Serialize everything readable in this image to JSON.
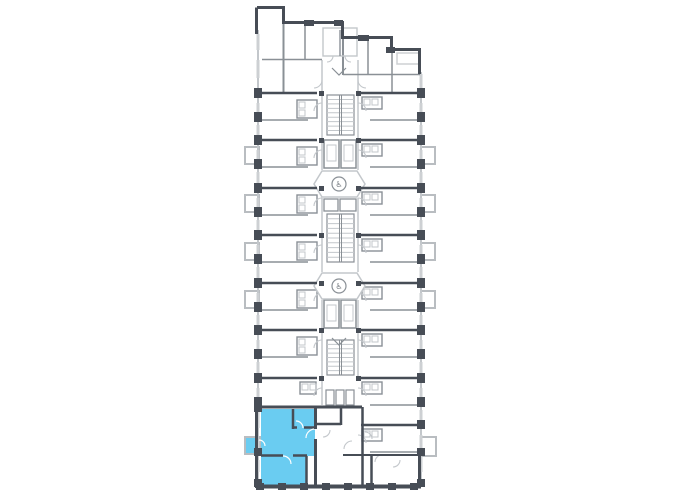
{
  "canvas": {
    "width": 680,
    "height": 500,
    "background": "#ffffff"
  },
  "palette": {
    "wall_dark": "#474d56",
    "wall_medium": "#8a9096",
    "wall_light": "#c3c7cb",
    "window": "#cdd0d3",
    "balcony_stroke": "#b9bdc1",
    "highlight_fill": "#6accf1",
    "glyph": "#70767c"
  },
  "icons": {
    "elevator_symbol": "♿"
  },
  "plan": {
    "outline_dark": [
      [
        257,
        7.5,
        285,
        7.5,
        3
      ],
      [
        283.5,
        7.5,
        283.5,
        24,
        3
      ],
      [
        283,
        22.5,
        344,
        22.5,
        3
      ],
      [
        342.5,
        22.5,
        342.5,
        39,
        3
      ],
      [
        343,
        37.5,
        393,
        37.5,
        3
      ],
      [
        391.5,
        37.5,
        391.5,
        51,
        3
      ],
      [
        392,
        49.5,
        421,
        49.5,
        3
      ],
      [
        419.5,
        49.5,
        419.5,
        74,
        3
      ],
      [
        256.5,
        7.5,
        256.5,
        34,
        3
      ],
      [
        258,
        486.5,
        421,
        486.5,
        4
      ],
      [
        419.5,
        455,
        419.5,
        488,
        3
      ],
      [
        256.5,
        400,
        256.5,
        488,
        3
      ]
    ],
    "dark_walls": [
      [
        259,
        93,
        317,
        93,
        2.5
      ],
      [
        259,
        140,
        317,
        140,
        2.5
      ],
      [
        259,
        188,
        317,
        188,
        2.5
      ],
      [
        259,
        235,
        317,
        235,
        2.5
      ],
      [
        259,
        283,
        317,
        283,
        2.5
      ],
      [
        259,
        330,
        317,
        330,
        2.5
      ],
      [
        259,
        378,
        317,
        378,
        2.5
      ],
      [
        256,
        407,
        317,
        407,
        3
      ],
      [
        361,
        93,
        420,
        93,
        2.5
      ],
      [
        361,
        140,
        420,
        140,
        2.5
      ],
      [
        361,
        188,
        420,
        188,
        2.5
      ],
      [
        361,
        235,
        420,
        235,
        2.5
      ],
      [
        361,
        283,
        420,
        283,
        2.5
      ],
      [
        361,
        330,
        420,
        330,
        2.5
      ],
      [
        361,
        378,
        420,
        378,
        2.5
      ],
      [
        361,
        425,
        420,
        425,
        2.5
      ],
      [
        315.5,
        407,
        315.5,
        429,
        3
      ],
      [
        315.5,
        439,
        315.5,
        488,
        3
      ],
      [
        341,
        407,
        341,
        425,
        2.5
      ],
      [
        362.5,
        407,
        362.5,
        488,
        2.5
      ],
      [
        316,
        424,
        341,
        424,
        2.5
      ],
      [
        343,
        455,
        420,
        455,
        2
      ],
      [
        371.5,
        455,
        371.5,
        488,
        2.5
      ],
      [
        316,
        407,
        362,
        407,
        3
      ]
    ],
    "medium_walls": [
      [
        283.5,
        24,
        283.5,
        93,
        2
      ],
      [
        305,
        24,
        305,
        60,
        1.5
      ],
      [
        262,
        59.5,
        322,
        59.5,
        1.5
      ],
      [
        343,
        39,
        343,
        75,
        2
      ],
      [
        368,
        39,
        368,
        75,
        1.5
      ],
      [
        392,
        51,
        392,
        93,
        1.5
      ],
      [
        343,
        74.5,
        420,
        74.5,
        1.5
      ]
    ],
    "light_walls": [
      [
        322,
        60,
        322,
        170,
        1.5
      ],
      [
        322,
        198,
        322,
        272,
        1.5
      ],
      [
        322,
        300,
        322,
        405,
        1.5
      ],
      [
        358,
        60,
        358,
        170,
        1.5
      ],
      [
        358,
        198,
        358,
        272,
        1.5
      ],
      [
        358,
        300,
        358,
        376,
        1.5
      ],
      [
        258,
        30,
        258,
        486,
        2
      ],
      [
        421,
        72,
        421,
        486,
        2
      ]
    ],
    "modules": {
      "left": {
        "ys": [
          93,
          140,
          188,
          235,
          283,
          330
        ],
        "partition": [
          262,
          308
        ],
        "bath": [
          297,
          7,
          20,
          18
        ],
        "wall_x": 258
      },
      "right": {
        "ys": [
          93,
          140,
          188,
          235,
          283,
          330,
          378,
          425
        ],
        "partition": [
          370,
          420
        ],
        "bath": [
          362,
          4,
          20,
          12
        ],
        "wall_x": 421
      },
      "left_mini": {
        "ys": [
          378
        ],
        "bath": [
          300,
          4,
          16,
          12
        ],
        "wall_x": 258
      }
    },
    "pilasters": {
      "left_x": 254,
      "right_x": 417,
      "w": 8,
      "h": 10,
      "ys": [
        88,
        112,
        135,
        159,
        183,
        207,
        230,
        254,
        278,
        302,
        325,
        349,
        373,
        397
      ],
      "extra": [
        [
          254,
          403,
          8,
          9
        ],
        [
          254,
          448,
          8,
          8
        ],
        [
          254,
          479,
          8,
          8
        ],
        [
          417,
          420,
          8,
          9
        ],
        [
          417,
          448,
          8,
          8
        ],
        [
          417,
          479,
          8,
          8
        ]
      ],
      "bottom_xs": [
        256,
        278,
        300,
        322,
        344,
        366,
        388,
        410
      ],
      "bottom_y": 483,
      "bw": 8,
      "bh": 7,
      "top": [
        [
          304,
          20,
          10,
          6
        ],
        [
          334,
          20,
          9,
          6
        ],
        [
          358,
          35,
          11,
          6
        ],
        [
          386,
          47,
          9,
          6
        ]
      ]
    },
    "windows": {
      "left_extra": [
        [
          34,
          50
        ],
        [
          60,
          78
        ],
        [
          412,
          428
        ],
        [
          440,
          452
        ],
        [
          460,
          472
        ]
      ],
      "right_extra": [
        [
          74,
          88
        ],
        [
          458,
          472
        ]
      ],
      "top": [
        [
          263,
          281,
          7.5
        ],
        [
          289,
          303,
          22.5
        ],
        [
          312,
          326,
          22.5
        ],
        [
          329,
          340,
          22.5
        ],
        [
          347,
          358,
          37.5
        ],
        [
          370,
          388,
          37.5
        ],
        [
          395,
          417,
          49.5
        ]
      ],
      "bottom": {
        "y": 486.5,
        "pairs": [
          [
            265,
            277
          ],
          [
            287,
            299
          ],
          [
            309,
            321
          ],
          [
            331,
            343
          ],
          [
            353,
            365
          ],
          [
            375,
            387
          ],
          [
            397,
            409
          ]
        ]
      },
      "loggia_rect": [
        397,
        53,
        22,
        11
      ]
    },
    "balconies": [
      {
        "x": 245,
        "y": 147,
        "w": 14,
        "h": 17,
        "side": "left"
      },
      {
        "x": 245,
        "y": 195,
        "w": 14,
        "h": 17,
        "side": "left"
      },
      {
        "x": 245,
        "y": 243,
        "w": 14,
        "h": 17,
        "side": "left"
      },
      {
        "x": 245,
        "y": 291,
        "w": 14,
        "h": 17,
        "side": "left"
      },
      {
        "x": 421,
        "y": 147,
        "w": 14,
        "h": 17,
        "side": "right"
      },
      {
        "x": 421,
        "y": 195,
        "w": 14,
        "h": 17,
        "side": "right"
      },
      {
        "x": 421,
        "y": 243,
        "w": 14,
        "h": 17,
        "side": "right"
      },
      {
        "x": 421,
        "y": 291,
        "w": 14,
        "h": 17,
        "side": "right"
      },
      {
        "x": 421,
        "y": 437,
        "w": 15,
        "h": 19,
        "side": "right"
      }
    ],
    "core": {
      "top_room": {
        "rect": [
          323,
          28,
          34,
          28
        ],
        "divider": [
          340,
          30,
          340,
          56
        ]
      },
      "stairs": [
        {
          "x": 327,
          "y": 95,
          "w": 27,
          "h": 40,
          "steps": 9
        },
        {
          "x": 327,
          "y": 214,
          "w": 27,
          "h": 48,
          "steps": 10
        },
        {
          "x": 327,
          "y": 340,
          "w": 27,
          "h": 35,
          "steps": 8
        }
      ],
      "shafts": [
        [
          324,
          140,
          15,
          28
        ],
        [
          341,
          140,
          15,
          28
        ],
        [
          324,
          300,
          15,
          28
        ],
        [
          341,
          300,
          15,
          28
        ]
      ],
      "shaft_inner": [
        [
          327,
          145,
          9,
          16
        ],
        [
          344,
          145,
          9,
          16
        ],
        [
          327,
          305,
          9,
          16
        ],
        [
          344,
          305,
          9,
          16
        ]
      ],
      "machines": [
        [
          324,
          199,
          14,
          12
        ],
        [
          340,
          199,
          16,
          12
        ]
      ],
      "slats": [
        [
          326,
          390,
          8,
          15
        ],
        [
          336,
          390,
          8,
          15
        ],
        [
          346,
          390,
          8,
          15
        ]
      ],
      "lobbies": [
        "322,171 357,171 365,184 357,197 322,197 314,184",
        "322,273 357,273 365,286 357,299 322,299 314,286"
      ],
      "elevators": [
        {
          "cx": 339,
          "cy": 184,
          "r": 7
        },
        {
          "cx": 339,
          "cy": 286,
          "r": 7
        }
      ],
      "chevrons": [
        "332,68 339,75 346,68",
        "332,338 339,345 346,338"
      ],
      "ticks_ys": [
        93,
        140,
        188,
        235,
        283,
        330,
        378
      ]
    },
    "arcs": [
      "M314,111 A8,8 0 0 1 322,103",
      "M358,103 A8,8 0 0 1 366,111",
      "M314,158 A8,8 0 0 1 322,150",
      "M358,150 A8,8 0 0 1 366,158",
      "M314,206 A8,8 0 0 1 322,198",
      "M358,198 A8,8 0 0 1 366,206",
      "M314,253 A8,8 0 0 1 322,245",
      "M358,245 A8,8 0 0 1 366,253",
      "M314,301 A8,8 0 0 1 322,293",
      "M358,293 A8,8 0 0 1 366,301",
      "M314,348 A8,8 0 0 1 322,340",
      "M358,340 A8,8 0 0 1 366,348",
      "M314,396 A8,8 0 0 1 322,388",
      "M358,388 A8,8 0 0 1 366,396",
      "M358,435 A8,8 0 0 1 366,443",
      "M322,80 A8,8 0 0 1 314,88",
      "M358,80 A8,8 0 0 0 366,88",
      "M333,56 A6,6 0 0 1 327,62",
      "M345,56 A6,6 0 0 0 351,62",
      "M330,430 A7,7 0 0 1 323,437",
      "M352,441 A8,8 0 0 0 344,449",
      "M365,432 A7,7 0 0 1 372,439",
      "M382,455 A7,7 0 0 0 375,462",
      "M400,460 A7,7 0 0 1 393,467"
    ],
    "highlight": {
      "poly": "261,409 315,409 315,456 307,456 307,487 261,487",
      "balcony": {
        "x": 245,
        "y": 437,
        "w": 15,
        "h": 17
      },
      "walls": [
        [
          293,
          409,
          293,
          429,
          2.5
        ],
        [
          293,
          427.5,
          297,
          427.5,
          2.5
        ],
        [
          304,
          427.5,
          315,
          427.5,
          2.5
        ],
        [
          261,
          455.5,
          283,
          455.5,
          2.5
        ],
        [
          293,
          455.5,
          307,
          455.5,
          2.5
        ],
        [
          306.5,
          456,
          306.5,
          488,
          2.5
        ]
      ],
      "arcs": [
        "M303,428 A7,7 0 0 0 296,421",
        "M315,429 A9,9 0 0 0 306,438",
        "M283,456 A8,8 0 0 1 291,464",
        "M259,440 A6,6 0 0 1 265,446"
      ]
    }
  }
}
